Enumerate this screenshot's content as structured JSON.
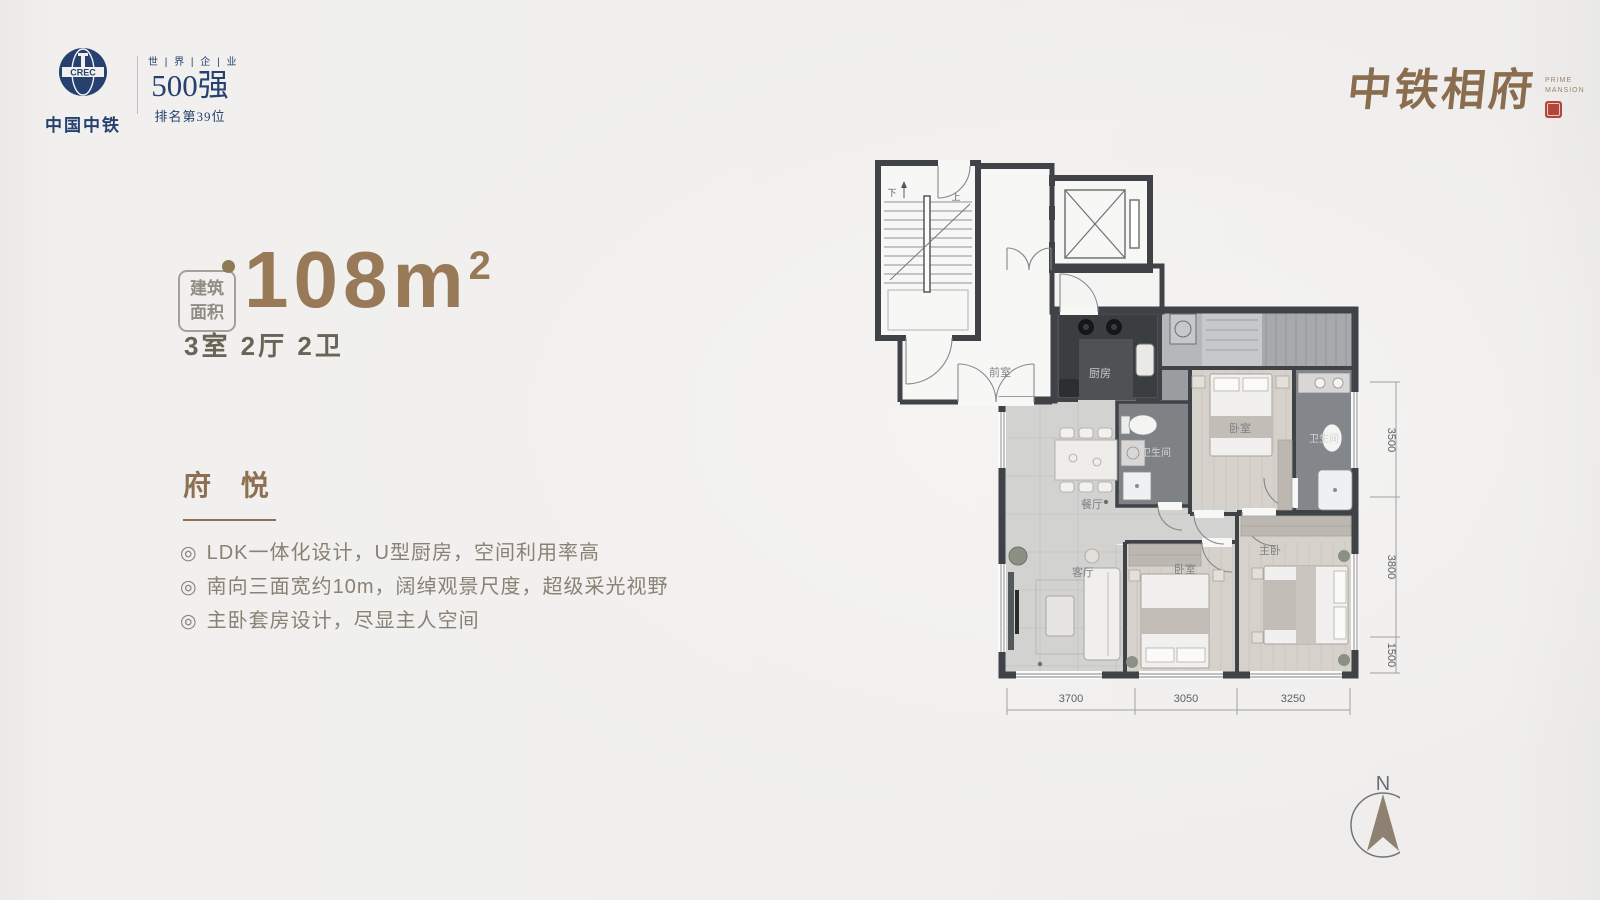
{
  "header": {
    "logo": {
      "name": "中国中铁",
      "abbr": "CREC"
    },
    "fortune": {
      "top": "世 | 界 | 企 | 业",
      "main": "500强",
      "sub": "排名第39位"
    },
    "brand": {
      "name": "中铁相府",
      "en_line1": "PRIME",
      "en_line2": "MANSION"
    }
  },
  "info": {
    "area_badge": {
      "line1": "建筑",
      "line2": "面积"
    },
    "area": {
      "value": "108",
      "unit": "m",
      "sup": "2"
    },
    "layout": "3室 2厅 2卫",
    "section_title": "府 悦",
    "bullet": "◎",
    "features": [
      "LDK一体化设计，U型厨房，空间利用率高",
      "南向三面宽约10m，阔绰观景尺度，超级采光视野",
      "主卧套房设计，尽显主人空间"
    ]
  },
  "floorplan": {
    "rooms": {
      "vestibule": "前室",
      "kitchen": "厨房",
      "bath_middle": "卫生间",
      "bath_right": "卫生间",
      "bedroom_north": "卧室",
      "dining": "餐厅",
      "living": "客厅",
      "bedroom_middle": "卧室",
      "master": "主卧"
    },
    "stair": {
      "down": "下",
      "up": "上"
    },
    "dimensions": {
      "bottom": [
        "3700",
        "3050",
        "3250"
      ],
      "right": [
        "3500",
        "3800",
        "1500"
      ]
    },
    "compass": "N",
    "colors": {
      "wall": "#3f4347",
      "accent_brown": "#997a58",
      "navy": "#26406f",
      "seal_red": "#b2453c"
    }
  }
}
